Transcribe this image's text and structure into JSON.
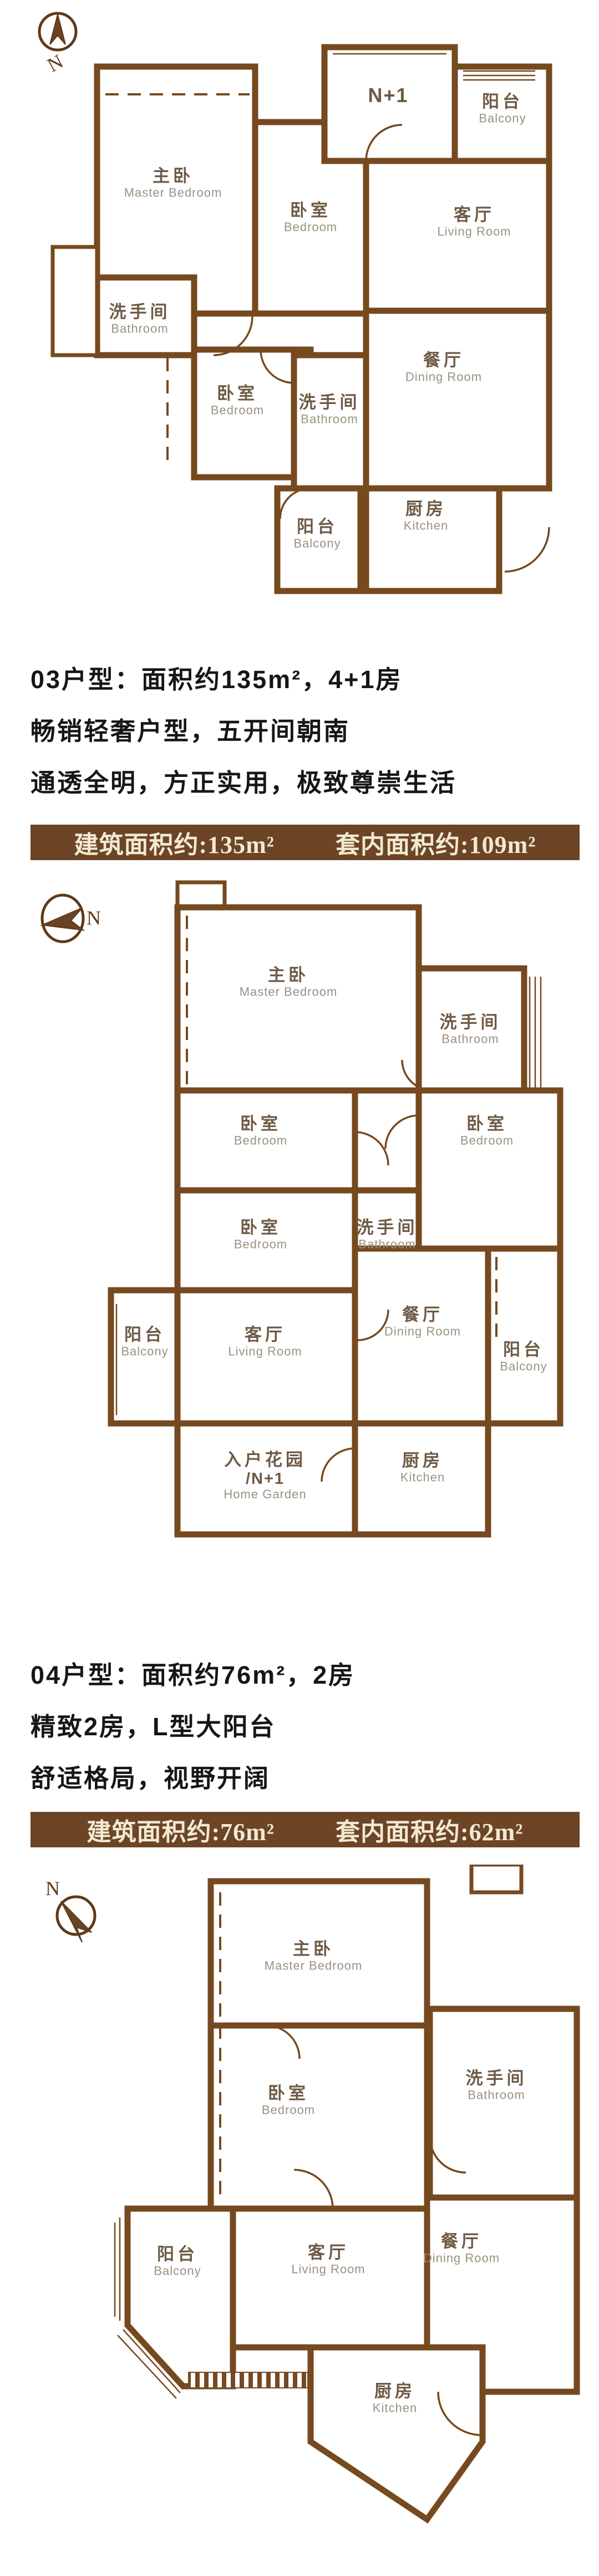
{
  "compass": {
    "label": "N"
  },
  "colors": {
    "wall": "#76491f",
    "banner_bg": "#6b4526",
    "banner_text": "#f3e9d3",
    "label_zh": "#6e5a44",
    "label_en": "#9a9181"
  },
  "plans": [
    {
      "name": "top-floor-plan",
      "rooms": [
        {
          "zh": "主卧",
          "en": "Master Bedroom"
        },
        {
          "zh": "卧室",
          "en": "Bedroom"
        },
        {
          "zh": "N+1",
          "en": ""
        },
        {
          "zh": "阳台",
          "en": "Balcony"
        },
        {
          "zh": "客厅",
          "en": "Living Room"
        },
        {
          "zh": "洗手间",
          "en": "Bathroom"
        },
        {
          "zh": "卧室",
          "en": "Bedroom"
        },
        {
          "zh": "洗手间",
          "en": "Bathroom"
        },
        {
          "zh": "餐厅",
          "en": "Dining Room"
        },
        {
          "zh": "阳台",
          "en": "Balcony"
        },
        {
          "zh": "厨房",
          "en": "Kitchen"
        }
      ]
    },
    {
      "name": "middle-floor-plan",
      "rooms": [
        {
          "zh": "主卧",
          "en": "Master Bedroom"
        },
        {
          "zh": "洗手间",
          "en": "Bathroom"
        },
        {
          "zh": "卧室",
          "en": "Bedroom"
        },
        {
          "zh": "卧室",
          "en": "Bedroom"
        },
        {
          "zh": "卧室",
          "en": "Bedroom"
        },
        {
          "zh": "洗手间",
          "en": "Bathroom"
        },
        {
          "zh": "阳台",
          "en": "Balcony"
        },
        {
          "zh": "客厅",
          "en": "Living Room"
        },
        {
          "zh": "餐厅",
          "en": "Dining Room"
        },
        {
          "zh": "阳台",
          "en": "Balcony"
        },
        {
          "zh": "入户花园",
          "mid": "/N+1",
          "en": "Home Garden"
        },
        {
          "zh": "厨房",
          "en": "Kitchen"
        }
      ]
    },
    {
      "name": "bottom-floor-plan",
      "rooms": [
        {
          "zh": "主卧",
          "en": "Master Bedroom"
        },
        {
          "zh": "卧室",
          "en": "Bedroom"
        },
        {
          "zh": "洗手间",
          "en": "Bathroom"
        },
        {
          "zh": "阳台",
          "en": "Balcony"
        },
        {
          "zh": "客厅",
          "en": "Living Room"
        },
        {
          "zh": "餐厅",
          "en": "Dining Room"
        },
        {
          "zh": "厨房",
          "en": "Kitchen"
        }
      ]
    }
  ],
  "sections": [
    {
      "heading": "03户型：面积约135m²，4+1房",
      "line2": "畅销轻奢户型，五开间朝南",
      "line3": "通透全明，方正实用，极致尊崇生活",
      "banner": {
        "built": "建筑面积约:135m²",
        "inner": "套内面积约:109m²"
      }
    },
    {
      "heading": "04户型：面积约76m²，2房",
      "line2": "精致2房，L型大阳台",
      "line3": "舒适格局，视野开阔",
      "banner": {
        "built": "建筑面积约:76m²",
        "inner": "套内面积约:62m²"
      }
    }
  ]
}
